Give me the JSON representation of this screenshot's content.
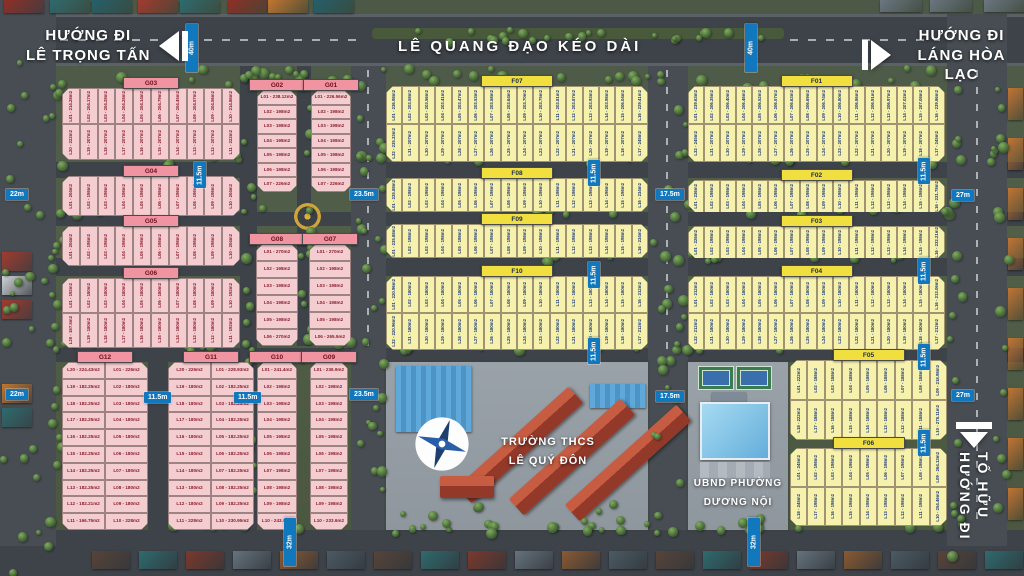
{
  "roads": {
    "main_label": "LÊ QUANG ĐẠO KÉO DÀI"
  },
  "signs": {
    "top_left": {
      "line1": "HƯỚNG ĐI",
      "line2": "LÊ TRỌNG TẤN",
      "arrow": "left"
    },
    "top_right": {
      "line1": "HƯỚNG ĐI",
      "line2": "LÁNG HÒA LẠC",
      "arrow": "right"
    },
    "bottom_right": {
      "line1": "HƯỚNG ĐI",
      "line2": "TỐ HỮU",
      "arrow": "down"
    }
  },
  "landmarks": {
    "school": {
      "line1": "TRƯỜNG THCS",
      "line2": "LÊ QUÝ ĐÔN"
    },
    "ward_office": {
      "line1": "UBND PHƯỜNG",
      "line2": "DƯƠNG NỘI"
    }
  },
  "colors": {
    "lot_pink": "#f4cdd1",
    "lot_yellow": "#f6f2ae",
    "header_pink": "#ef94a0",
    "header_yellow": "#f0df3e",
    "measure_blue": "#1178be",
    "road": "#3d4349",
    "grass": "#52604a"
  },
  "measurements": [
    {
      "label": "40m",
      "x": 186,
      "y": 24,
      "v": 1,
      "h": 48
    },
    {
      "label": "40m",
      "x": 745,
      "y": 24,
      "v": 1,
      "h": 48
    },
    {
      "label": "22m",
      "x": 6,
      "y": 189
    },
    {
      "label": "22m",
      "x": 6,
      "y": 389
    },
    {
      "label": "11.5m",
      "x": 194,
      "y": 162,
      "v": 1,
      "h": 26
    },
    {
      "label": "23.5m",
      "x": 350,
      "y": 189
    },
    {
      "label": "23.5m",
      "x": 350,
      "y": 389
    },
    {
      "label": "17.5m",
      "x": 656,
      "y": 189
    },
    {
      "label": "17.5m",
      "x": 656,
      "y": 391
    },
    {
      "label": "27m",
      "x": 952,
      "y": 190
    },
    {
      "label": "27m",
      "x": 952,
      "y": 390
    },
    {
      "label": "11.5m",
      "x": 588,
      "y": 160,
      "v": 1,
      "h": 26
    },
    {
      "label": "11.5m",
      "x": 588,
      "y": 262,
      "v": 1,
      "h": 26
    },
    {
      "label": "11.5m",
      "x": 588,
      "y": 338,
      "v": 1,
      "h": 26
    },
    {
      "label": "11.5m",
      "x": 918,
      "y": 158,
      "v": 1,
      "h": 26
    },
    {
      "label": "11.5m",
      "x": 918,
      "y": 258,
      "v": 1,
      "h": 26
    },
    {
      "label": "11.5m",
      "x": 918,
      "y": 344,
      "v": 1,
      "h": 26
    },
    {
      "label": "11.5m",
      "x": 918,
      "y": 430,
      "v": 1,
      "h": 26
    },
    {
      "label": "11.5m",
      "x": 144,
      "y": 392
    },
    {
      "label": "11.5m",
      "x": 234,
      "y": 392
    },
    {
      "label": "32m",
      "x": 284,
      "y": 518,
      "v": 1,
      "h": 48
    },
    {
      "label": "32m",
      "x": 748,
      "y": 518,
      "v": 1,
      "h": 48
    }
  ],
  "blocks": [
    {
      "id": "G03",
      "color": "pink",
      "x": 62,
      "y": 88,
      "w": 178,
      "h": 72,
      "dir": "rows",
      "rows": [
        [
          "L01 - 214.28m2",
          "L02 - 204.17m2",
          "L03 - 204.28m2",
          "L04 - 204.28m2",
          "L05 - 204.14m2",
          "L06 - 204.79m2",
          "L07 - 204.45m2",
          "L08 - 204.57m2",
          "L09 - 204.56m2",
          "L10 - 214.86m2"
        ],
        [
          "L20 - 222m2",
          "L19 - 207m2",
          "L18 - 207m2",
          "L17 - 207m2",
          "L16 - 207m2",
          "L15 - 207m2",
          "L14 - 207m2",
          "L13 - 207m2",
          "L12 - 207m2",
          "L11 - 222m2"
        ]
      ]
    },
    {
      "id": "G04",
      "color": "pink",
      "x": 62,
      "y": 176,
      "w": 178,
      "h": 40,
      "dir": "rows",
      "rows": [
        [
          "L01 - 204m2",
          "L02 - 198m2",
          "L03 - 198m2",
          "L04 - 198m2",
          "L05 - 198m2",
          "L06 - 198m2",
          "L07 - 198m2",
          "L08 - 198m2",
          "L09 - 198m2",
          "L10 - 204m2"
        ]
      ]
    },
    {
      "id": "G05",
      "color": "pink",
      "x": 62,
      "y": 226,
      "w": 178,
      "h": 40,
      "dir": "rows",
      "rows": [
        [
          "L01 - 204m2",
          "L02 - 198m2",
          "L03 - 198m2",
          "L04 - 198m2",
          "L05 - 198m2",
          "L06 - 198m2",
          "L07 - 198m2",
          "L08 - 198m2",
          "L09 - 198m2",
          "L10 - 204m2"
        ]
      ]
    },
    {
      "id": "G06",
      "color": "pink",
      "x": 62,
      "y": 278,
      "w": 178,
      "h": 70,
      "dir": "rows",
      "rows": [
        [
          "L01 - 192m2",
          "L02 - 180m2",
          "L03 - 180m2",
          "L04 - 180m2",
          "L05 - 180m2",
          "L06 - 180m2",
          "L07 - 180m2",
          "L08 - 180m2",
          "L09 - 180m2",
          "L10 - 192m2"
        ],
        [
          "L20 - 187.5m2",
          "L19 - 180m2",
          "L18 - 180m2",
          "L17 - 180m2",
          "L16 - 180m2",
          "L15 - 180m2",
          "L14 - 180m2",
          "L13 - 180m2",
          "L12 - 180m2",
          "L11 - 192m2"
        ]
      ]
    },
    {
      "id": "G02",
      "color": "pink",
      "x": 257,
      "y": 90,
      "w": 40,
      "h": 102,
      "dir": "cols",
      "rows": [
        [
          "L01 - 238.12m2",
          "L02 - 198m2",
          "L03 - 198m2",
          "L04 - 198m2",
          "L05 - 198m2",
          "L06 - 198m2",
          "L07 - 226m2"
        ]
      ]
    },
    {
      "id": "G01",
      "color": "pink",
      "x": 311,
      "y": 90,
      "w": 40,
      "h": 102,
      "dir": "cols",
      "rows": [
        [
          "L01 - 226.56m2",
          "L02 - 198m2",
          "L03 - 198m2",
          "L04 - 198m2",
          "L05 - 198m2",
          "L06 - 198m2",
          "L07 - 226m2"
        ]
      ]
    },
    {
      "id": "G08",
      "color": "pink",
      "x": 256,
      "y": 244,
      "w": 42,
      "h": 102,
      "dir": "cols",
      "rows": [
        [
          "L01 - 270m2",
          "L02 - 198m2",
          "L03 - 198m2",
          "L04 - 198m2",
          "L05 - 198m2",
          "L06 - 270m2"
        ]
      ]
    },
    {
      "id": "G07",
      "color": "pink",
      "x": 309,
      "y": 244,
      "w": 42,
      "h": 102,
      "dir": "cols",
      "rows": [
        [
          "L01 - 270m2",
          "L02 - 198m2",
          "L03 - 198m2",
          "L04 - 198m2",
          "L05 - 198m2",
          "L06 - 265.5m2"
        ]
      ]
    },
    {
      "id": "G12",
      "color": "pink",
      "x": 62,
      "y": 362,
      "w": 86,
      "h": 168,
      "dir": "cols",
      "rows": [
        [
          "L20 - 224.43m2",
          "L19 - 182.25m2",
          "L18 - 182.25m2",
          "L17 - 182.25m2",
          "L16 - 182.25m2",
          "L15 - 182.25m2",
          "L14 - 182.25m2",
          "L13 - 182.25m2",
          "L12 - 182.21m2",
          "L11 - 166.75m2"
        ],
        [
          "L01 - 226m2",
          "L02 - 180m2",
          "L03 - 180m2",
          "L04 - 180m2",
          "L05 - 180m2",
          "L06 - 180m2",
          "L07 - 180m2",
          "L08 - 180m2",
          "L09 - 180m2",
          "L10 - 228m2"
        ]
      ]
    },
    {
      "id": "G11",
      "color": "pink",
      "x": 168,
      "y": 362,
      "w": 86,
      "h": 168,
      "dir": "cols",
      "rows": [
        [
          "L20 - 226m2",
          "L19 - 180m2",
          "L18 - 180m2",
          "L17 - 180m2",
          "L16 - 180m2",
          "L15 - 180m2",
          "L14 - 180m2",
          "L13 - 180m2",
          "L12 - 180m2",
          "L11 - 228m2"
        ],
        [
          "L01 - 228.93m2",
          "L02 - 182.25m2",
          "L03 - 182.25m2",
          "L04 - 182.25m2",
          "L05 - 182.25m2",
          "L06 - 182.25m2",
          "L07 - 182.25m2",
          "L08 - 182.25m2",
          "L09 - 182.25m2",
          "L10 - 230.95m2"
        ]
      ]
    },
    {
      "id": "G10",
      "color": "pink",
      "x": 257,
      "y": 362,
      "w": 40,
      "h": 168,
      "dir": "cols",
      "rows": [
        [
          "L01 - 241.4m2",
          "L02 - 198m2",
          "L03 - 198m2",
          "L04 - 198m2",
          "L05 - 198m2",
          "L06 - 198m2",
          "L07 - 198m2",
          "L08 - 198m2",
          "L09 - 198m2",
          "L10 - 243.6m2"
        ]
      ]
    },
    {
      "id": "G09",
      "color": "pink",
      "x": 310,
      "y": 362,
      "w": 38,
      "h": 168,
      "dir": "cols",
      "rows": [
        [
          "L01 - 236.9m2",
          "L02 - 198m2",
          "L03 - 198m2",
          "L04 - 198m2",
          "L05 - 198m2",
          "L06 - 198m2",
          "L07 - 198m2",
          "L08 - 198m2",
          "L09 - 198m2",
          "L10 - 233.6m2"
        ]
      ]
    },
    {
      "id": "F07",
      "color": "yellow",
      "x": 386,
      "y": 86,
      "w": 262,
      "h": 76,
      "dir": "rows",
      "rows": [
        [
          "L01 - 236.98m2",
          "L02 - 203.58m2",
          "L03 - 203.56m2",
          "L04 - 203.41m2",
          "L05 - 203.47m2",
          "L06 - 203.53m2",
          "L07 - 203.58m2",
          "L08 - 203.64m2",
          "L09 - 203.70m2",
          "L10 - 203.75m2",
          "L11 - 203.81m2",
          "L12 - 203.87m2",
          "L13 - 203.93m2",
          "L14 - 203.98m2",
          "L15 - 206.04m2",
          "L16 - 229.41m2"
        ],
        [
          "L32 - 235.33m2",
          "L31 - 207m2",
          "L30 - 207m2",
          "L29 - 207m2",
          "L28 - 207m2",
          "L27 - 207m2",
          "L26 - 207m2",
          "L25 - 207m2",
          "L24 - 207m2",
          "L23 - 207m2",
          "L22 - 207m2",
          "L21 - 207m2",
          "L20 - 207m2",
          "L19 - 207m2",
          "L18 - 207m2",
          "L17 - 245m2"
        ]
      ]
    },
    {
      "id": "F08",
      "color": "yellow",
      "x": 386,
      "y": 178,
      "w": 262,
      "h": 34,
      "dir": "rows",
      "rows": [
        [
          "L01 - 235.88m2",
          "L02 - 198m2",
          "L03 - 198m2",
          "L04 - 198m2",
          "L05 - 198m2",
          "L06 - 198m2",
          "L07 - 198m2",
          "L08 - 198m2",
          "L09 - 198m2",
          "L10 - 198m2",
          "L11 - 198m2",
          "L12 - 198m2",
          "L13 - 198m2",
          "L14 - 198m2",
          "L15 - 198m2",
          "L16 - 234m2"
        ]
      ]
    },
    {
      "id": "F09",
      "color": "yellow",
      "x": 386,
      "y": 224,
      "w": 262,
      "h": 34,
      "dir": "rows",
      "rows": [
        [
          "L01 - 235.88m2",
          "L02 - 198m2",
          "L03 - 198m2",
          "L04 - 198m2",
          "L05 - 198m2",
          "L06 - 198m2",
          "L07 - 198m2",
          "L08 - 198m2",
          "L09 - 198m2",
          "L10 - 198m2",
          "L11 - 198m2",
          "L12 - 198m2",
          "L13 - 198m2",
          "L14 - 198m2",
          "L15 - 198m2",
          "L16 - 234m2"
        ]
      ]
    },
    {
      "id": "F10",
      "color": "yellow",
      "x": 386,
      "y": 276,
      "w": 262,
      "h": 74,
      "dir": "rows",
      "rows": [
        [
          "L01 - 220.96m2",
          "L02 - 180m2",
          "L03 - 180m2",
          "L04 - 180m2",
          "L05 - 180m2",
          "L06 - 180m2",
          "L07 - 180m2",
          "L08 - 180m2",
          "L09 - 180m2",
          "L10 - 180m2",
          "L11 - 180m2",
          "L12 - 180m2",
          "L13 - 180m2",
          "L14 - 180m2",
          "L15 - 180m2",
          "L16 - 212m2"
        ],
        [
          "L32 - 220.96m2",
          "L31 - 180m2",
          "L30 - 180m2",
          "L29 - 180m2",
          "L28 - 180m2",
          "L27 - 180m2",
          "L26 - 180m2",
          "L25 - 180m2",
          "L24 - 180m2",
          "L23 - 180m2",
          "L22 - 180m2",
          "L21 - 180m2",
          "L20 - 180m2",
          "L19 - 180m2",
          "L18 - 180m2",
          "L17 - 212m2"
        ]
      ]
    },
    {
      "id": "F01",
      "color": "yellow",
      "x": 688,
      "y": 86,
      "w": 257,
      "h": 76,
      "dir": "rows",
      "rows": [
        [
          "L01 - 239.63m2",
          "L02 - 206.35m2",
          "L03 - 206.40m2",
          "L04 - 206.46m2",
          "L05 - 206.52m2",
          "L06 - 206.57m2",
          "L07 - 206.63m2",
          "L08 - 206.69m2",
          "L09 - 206.74m2",
          "L10 - 206.80m2",
          "L11 - 206.86m2",
          "L12 - 206.91m2",
          "L13 - 206.97m2",
          "L14 - 207.02m2",
          "L15 - 207.08m2",
          "L16 - 239.86m2"
        ],
        [
          "L32 - 245m2",
          "L31 - 207m2",
          "L30 - 207m2",
          "L29 - 207m2",
          "L28 - 207m2",
          "L27 - 207m2",
          "L26 - 207m2",
          "L25 - 207m2",
          "L24 - 207m2",
          "L23 - 207m2",
          "L22 - 207m2",
          "L21 - 207m2",
          "L20 - 207m2",
          "L19 - 207m2",
          "L18 - 207m2",
          "L17 - 245m2"
        ]
      ]
    },
    {
      "id": "F02",
      "color": "yellow",
      "x": 688,
      "y": 180,
      "w": 257,
      "h": 32,
      "dir": "rows",
      "rows": [
        [
          "L01 - 236m2",
          "L02 - 198m2",
          "L03 - 198m2",
          "L04 - 198m2",
          "L05 - 198m2",
          "L06 - 198m2",
          "L07 - 198m2",
          "L08 - 198m2",
          "L09 - 198m2",
          "L10 - 198m2",
          "L11 - 198m2",
          "L12 - 198m2",
          "L13 - 198m2",
          "L14 - 198m2",
          "L15 - 198m2",
          "L16 - 231.78m2"
        ]
      ]
    },
    {
      "id": "F03",
      "color": "yellow",
      "x": 688,
      "y": 226,
      "w": 257,
      "h": 32,
      "dir": "rows",
      "rows": [
        [
          "L01 - 226m2",
          "L02 - 198m2",
          "L03 - 198m2",
          "L04 - 198m2",
          "L05 - 198m2",
          "L06 - 198m2",
          "L07 - 198m2",
          "L08 - 198m2",
          "L09 - 198m2",
          "L10 - 198m2",
          "L11 - 198m2",
          "L12 - 198m2",
          "L13 - 198m2",
          "L14 - 198m2",
          "L15 - 198m2",
          "L16 - 232.21m2"
        ]
      ]
    },
    {
      "id": "F04",
      "color": "yellow",
      "x": 688,
      "y": 276,
      "w": 257,
      "h": 74,
      "dir": "rows",
      "rows": [
        [
          "L01 - 212m2",
          "L02 - 180m2",
          "L03 - 180m2",
          "L04 - 180m2",
          "L05 - 180m2",
          "L06 - 180m2",
          "L07 - 180m2",
          "L08 - 180m2",
          "L09 - 180m2",
          "L10 - 180m2",
          "L11 - 180m2",
          "L12 - 180m2",
          "L13 - 180m2",
          "L14 - 180m2",
          "L15 - 180m2",
          "L16 - 213.06m2"
        ],
        [
          "L32 - 212m2",
          "L31 - 180m2",
          "L30 - 180m2",
          "L29 - 180m2",
          "L28 - 180m2",
          "L27 - 180m2",
          "L26 - 180m2",
          "L25 - 180m2",
          "L24 - 180m2",
          "L23 - 180m2",
          "L22 - 180m2",
          "L21 - 180m2",
          "L20 - 180m2",
          "L19 - 180m2",
          "L18 - 180m2",
          "L17 - 212m2"
        ]
      ]
    },
    {
      "id": "F05",
      "color": "yellow",
      "x": 790,
      "y": 360,
      "w": 157,
      "h": 80,
      "dir": "rows",
      "rows": [
        [
          "L01 - 222m2",
          "L02 - 188m2",
          "L03 - 188m2",
          "L04 - 188m2",
          "L05 - 188m2",
          "L06 - 188m2",
          "L07 - 188m2",
          "L08 - 188m2",
          "L09 - 218.98m2"
        ],
        [
          "L18 - 222m2",
          "L17 - 188m2",
          "L16 - 188m2",
          "L15 - 188m2",
          "L14 - 188m2",
          "L13 - 188m2",
          "L12 - 188m2",
          "L11 - 188m2",
          "L10 - 278.11m2"
        ]
      ]
    },
    {
      "id": "F06",
      "color": "yellow",
      "x": 790,
      "y": 448,
      "w": 157,
      "h": 78,
      "dir": "rows",
      "rows": [
        [
          "L01 - 245m2",
          "L02 - 198m2",
          "L03 - 198m2",
          "L04 - 198m2",
          "L05 - 198m2",
          "L06 - 198m2",
          "L07 - 198m2",
          "L08 - 198m2",
          "L09 - 264.13m2"
        ],
        [
          "L18 - 245m2",
          "L17 - 198m2",
          "L16 - 198m2",
          "L15 - 198m2",
          "L14 - 198m2",
          "L13 - 198m2",
          "L12 - 198m2",
          "L11 - 198m2",
          "L10 - 254.46m2"
        ]
      ]
    }
  ]
}
